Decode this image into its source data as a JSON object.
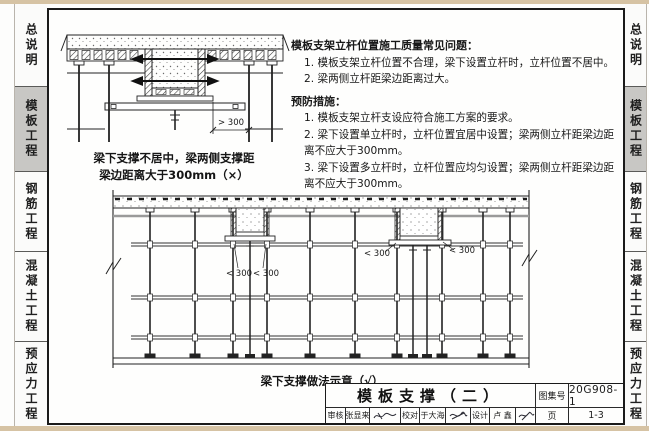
{
  "sidebar": {
    "active_tab": "模板工程",
    "active_color": "#c8c7c4",
    "tabs": [
      {
        "label": "总说明"
      },
      {
        "label": "模板工程"
      },
      {
        "label": "钢筋工程"
      },
      {
        "label": "混凝土工程"
      },
      {
        "label": "预应力工程"
      }
    ]
  },
  "problems": {
    "heading": "模板支架立杆位置施工质量常见问题：",
    "items": [
      "1. 模板支架立杆位置不合理，梁下设置立杆时，立杆位置不居中。",
      "2. 梁两侧立杆距梁边距离过大。"
    ]
  },
  "measures": {
    "heading": "预防措施：",
    "items": [
      "1. 模板支架立杆支设应符合施工方案的要求。",
      "2. 梁下设置单立杆时，立杆位置宜居中设置；梁两侧立杆距梁边距离不应大于300mm。",
      "3. 梁下设置多立杆时，立杆位置应均匀设置；梁两侧立杆距梁边距离不应大于300mm。"
    ]
  },
  "figure1": {
    "caption_line1": "梁下支撑不居中，梁两侧支撑距",
    "caption_line2": "梁边距离大于300mm（×）",
    "dim": "> 300"
  },
  "figure2": {
    "caption": "梁下支撑做法示意（√）",
    "dims": [
      "< 300",
      "< 300",
      "< 300",
      "< 300"
    ]
  },
  "title_block": {
    "drawing_title": "模板支撑（二）",
    "atlas_no_label": "图集号",
    "atlas_no": "20G908-1",
    "page_label": "页",
    "page_no": "1-3",
    "review_label": "审核",
    "reviewer": "张显来",
    "proof_label": "校对",
    "proofreader": "于大海",
    "design_label": "设计",
    "designer": "卢 鑫"
  }
}
